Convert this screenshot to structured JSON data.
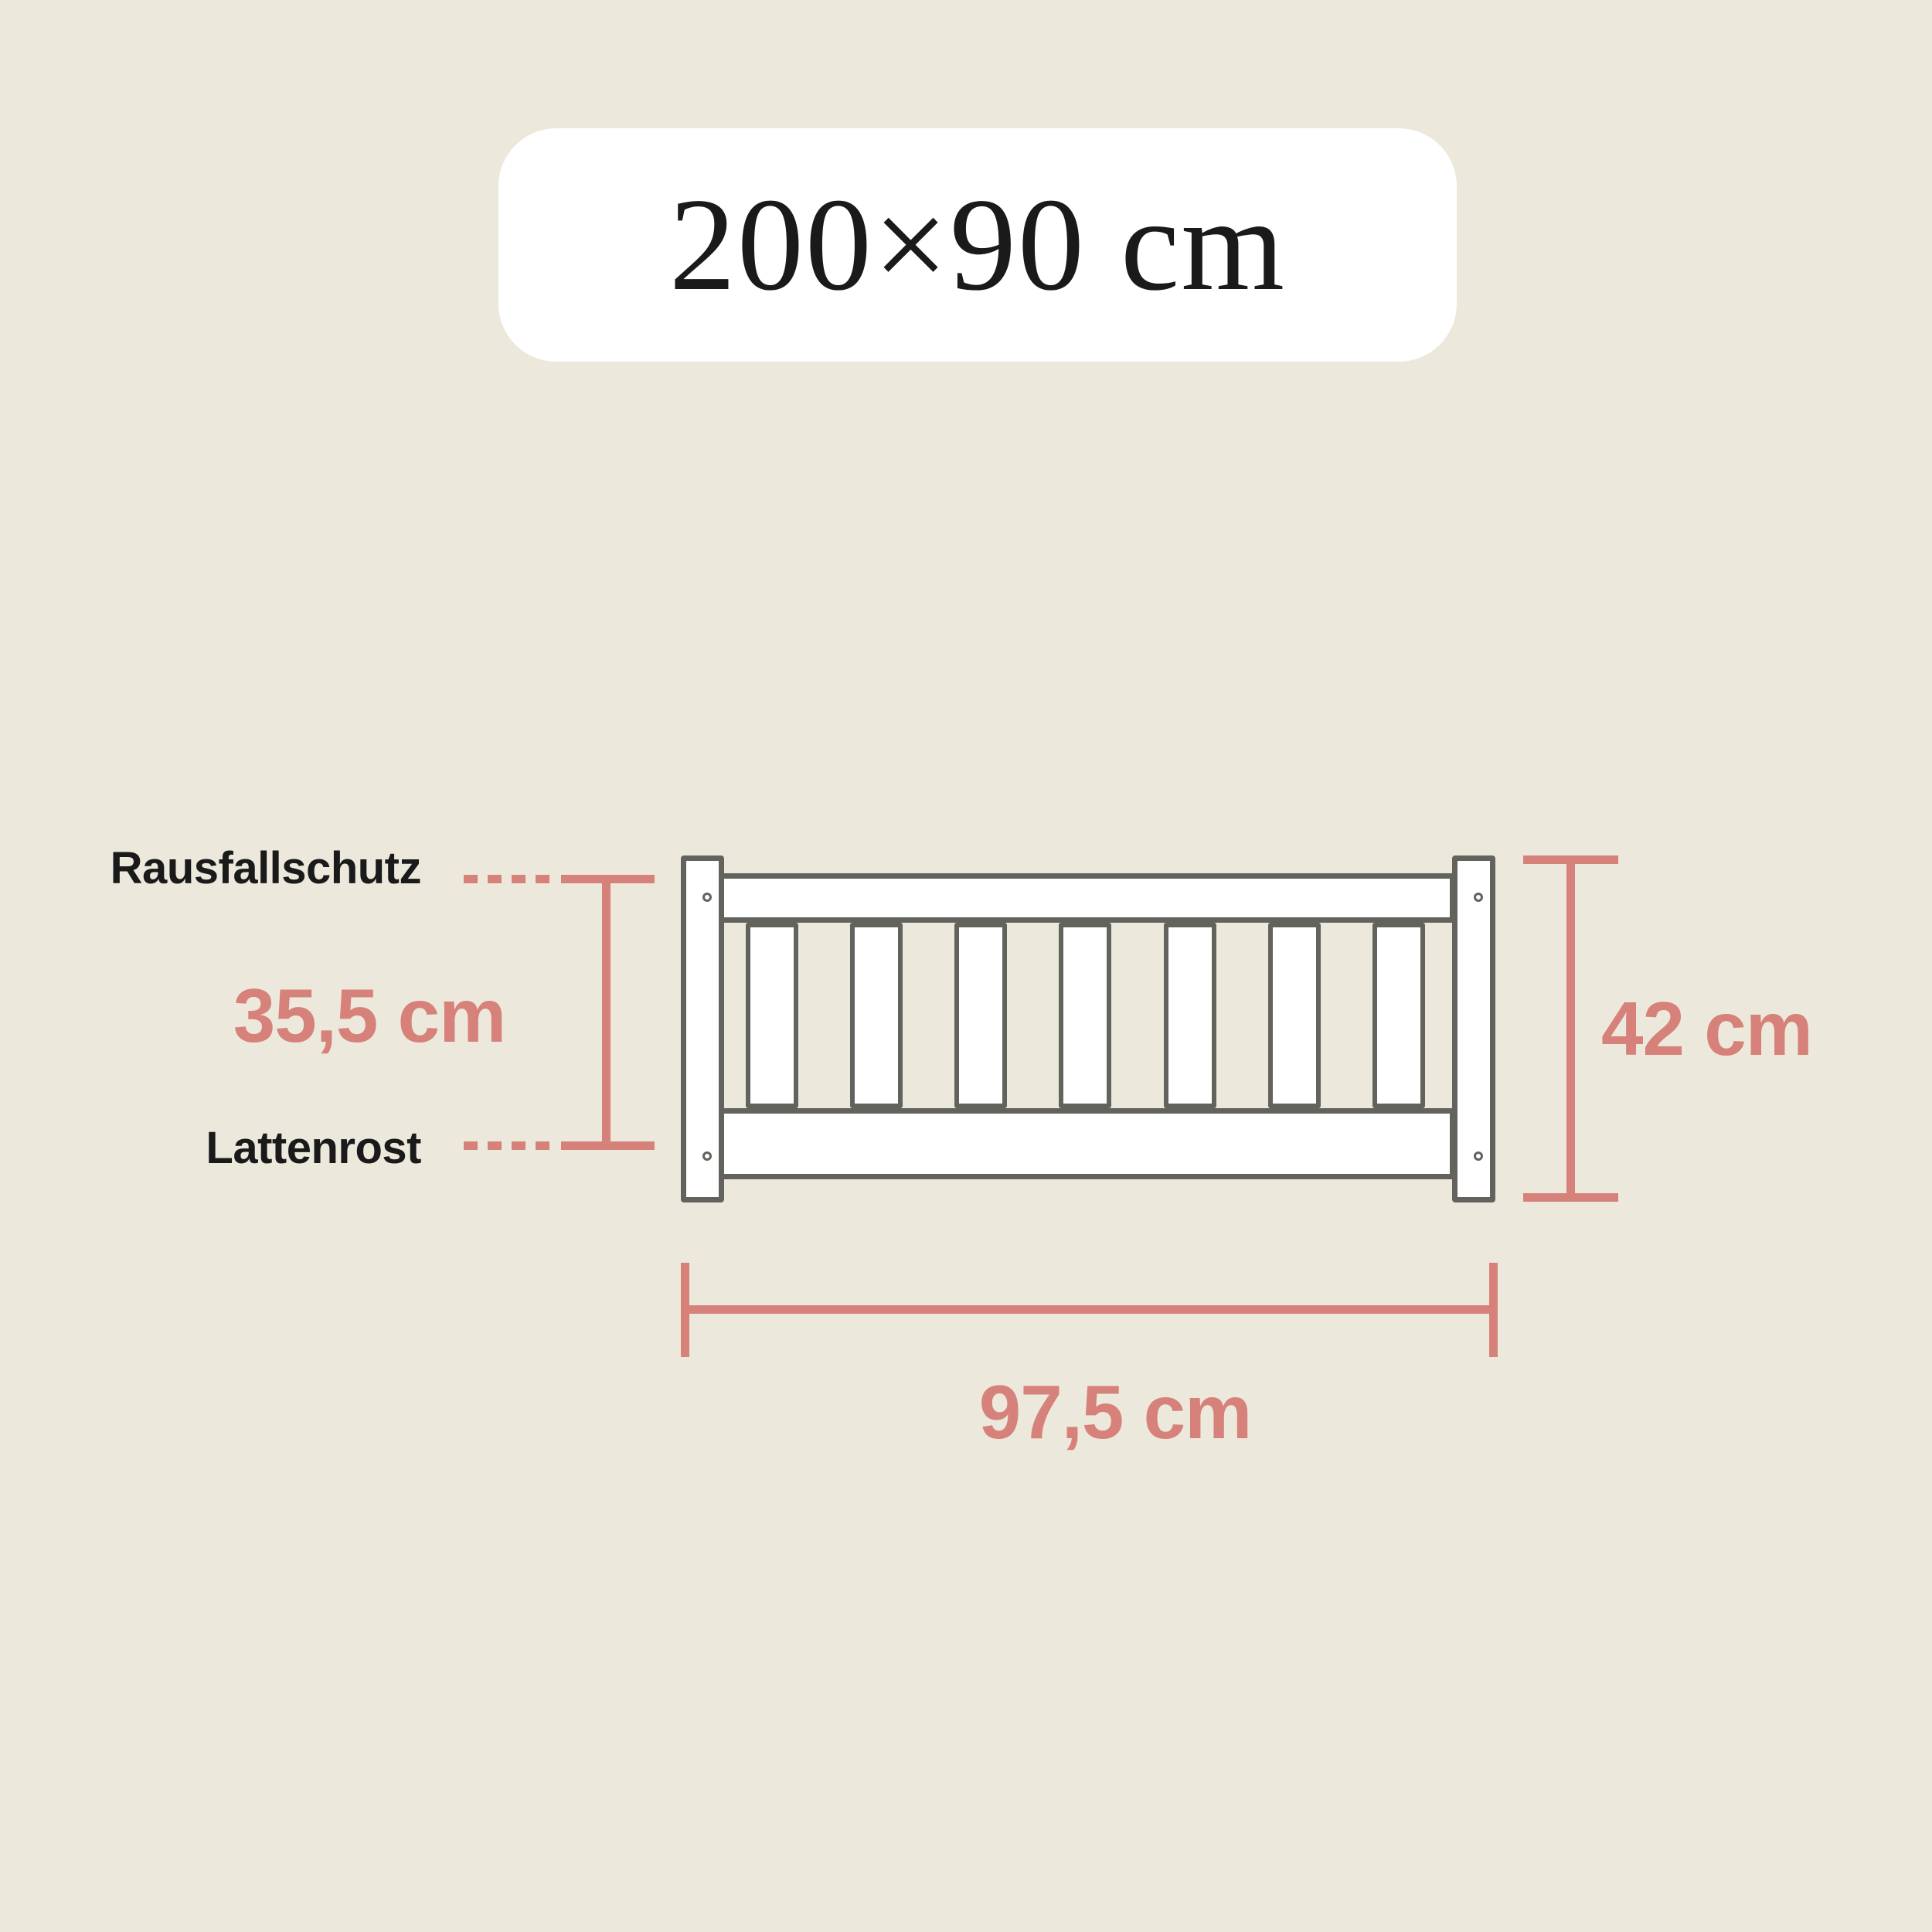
{
  "badge": {
    "size_label": "200×90 cm"
  },
  "colors": {
    "background": "#ECE9DC",
    "badge_background": "#FFFFFF",
    "text": "#1A1A1A",
    "accent": "#D6817A",
    "frame_outline": "#63635E",
    "wood_fill": "#FFFFFF"
  },
  "diagram": {
    "part_labels": {
      "rail_top": "Rausfallschutz",
      "slat_base": "Lattenrost"
    },
    "measurements": {
      "rail_height": "35,5 cm",
      "total_height": "42 cm",
      "rail_length": "97,5 cm"
    },
    "bed": {
      "slat_count": 7
    }
  }
}
